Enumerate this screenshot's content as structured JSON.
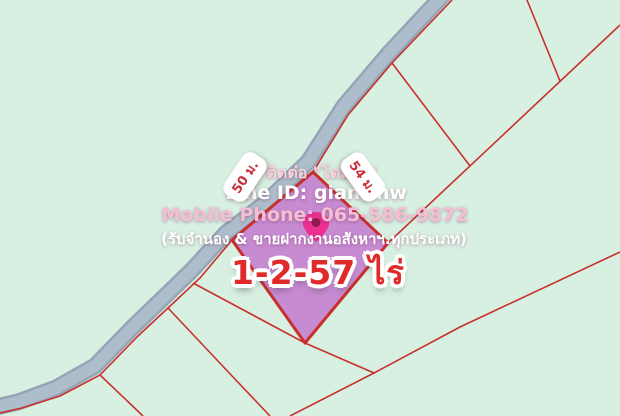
{
  "overlay": {
    "contact": "ติดต่อ \"โดมจ๋า\"",
    "line_id": "Line ID: giantmw",
    "phone": "Mobile Phone: 065-586-9872",
    "services": "(รับจำนอง & ขายฝากงานอสังหาฯ.ทุกประเภท)",
    "area": "1-2-57 ไร่"
  },
  "dimensions": {
    "left_edge": "50 ม.",
    "right_edge": "54 ม."
  },
  "icons": {
    "location_pin": "map-pin"
  },
  "colors": {
    "bg": "#d7f0e2",
    "road_fill": "#aebdcb",
    "road_edge": "#95a5b6",
    "parcel_fill": "#c78bd2",
    "line_red": "#c9302c",
    "area_red": "#e02a2a",
    "label_red": "#c9303a",
    "pin_pink": "#ed2f92",
    "pin_hole": "#8e1a4f",
    "text_white": "#ffffff",
    "text_pink1": "#f7d2da",
    "text_pink2": "#f6bed2"
  }
}
